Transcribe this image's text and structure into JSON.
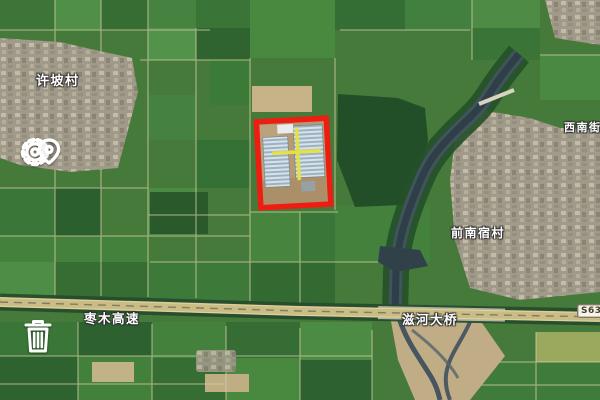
{
  "map": {
    "view_type": "satellite",
    "labels": {
      "village_top_left": "许坡村",
      "village_right": "前南宿村",
      "street_right_edge": "西南街",
      "expressway": "枣木高速",
      "bridge": "滋河大桥",
      "route_badge": "S63"
    },
    "icons": {
      "top_left_control": "gear-location-pin-icon",
      "bottom_left_control": "trash-icon"
    },
    "annotation": {
      "shape": "rectangle",
      "outline_color": "#ee1d12",
      "marker": "yellow-crosshair",
      "marker_color": "#e6e243"
    },
    "colors": {
      "farmland_green": "#457a3a",
      "river": "#2e3f48",
      "highway": "#cabc82",
      "village": "#a09a8a"
    }
  }
}
